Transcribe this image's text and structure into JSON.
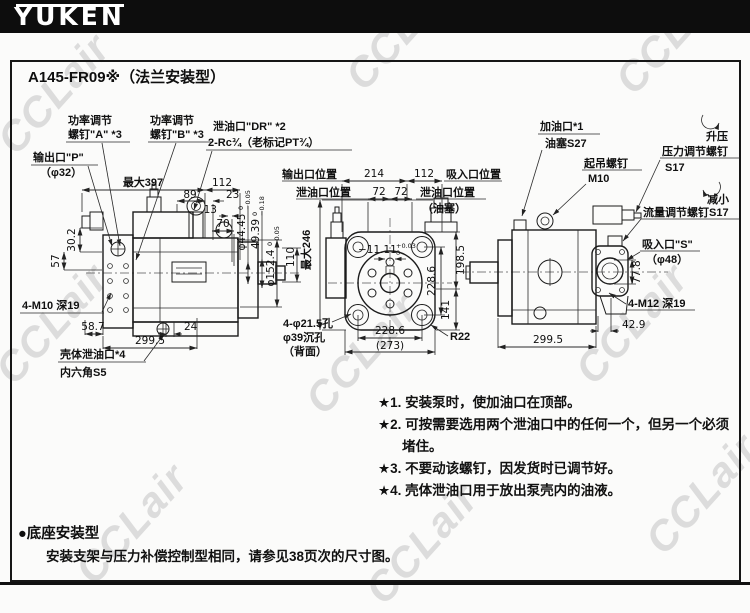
{
  "header": {
    "logo": "YUKEN"
  },
  "watermark": {
    "text": "CCLair"
  },
  "panel": {
    "title": "A145-FR09※（法兰安装型）"
  },
  "left_view": {
    "callouts": {
      "power_a1": "功率调节",
      "power_a2": "螺钉\"A\" *3",
      "power_b1": "功率调节",
      "power_b2": "螺钉\"B\" *3",
      "drain_dr1": "泄油口\"DR\" *2",
      "drain_dr2": "2-Rc¾（老标记PT¾）",
      "outlet1": "输出口\"P\"",
      "outlet2": "（φ32）",
      "mount_holes": "4-M10 深19",
      "case_drain1": "壳体泄油口*4",
      "case_drain2": "内六角S5"
    },
    "dims": {
      "max_len": "最大397",
      "d112": "112",
      "d89": "89",
      "d23": "23",
      "d13": "13",
      "d70": "70",
      "d30_2": "30.2",
      "d57": "57",
      "d58_7": "58.7",
      "d24": "24",
      "d299_5": "299.5",
      "d110": "110",
      "shaft_dia": {
        "main": "φ44.45",
        "tol_top": "0",
        "tol_bot": "−0.05"
      },
      "key_dim": {
        "main": "49.39",
        "tol_top": "0",
        "tol_bot": "−0.18"
      },
      "pilot_dia": {
        "main": "φ152.4",
        "tol_top": "0",
        "tol_bot": "−0.05"
      }
    }
  },
  "middle_view": {
    "callouts": {
      "outlet_pos": "输出口位置",
      "suction_pos": "吸入口位置",
      "drain_pos_l": "泄油口位置",
      "drain_pos_r": "泄油口位置",
      "drain_pos_r2": "（油塞）",
      "holes1": "4-φ21.5孔",
      "holes2": "φ39沉孔",
      "holes3": "（背面）",
      "r22": "R22"
    },
    "dims": {
      "d214": "214",
      "d112": "112",
      "d72a": "72",
      "d72b": "72",
      "max_h": "最大246",
      "d198_5": "198.5",
      "d228_6v": "228.6",
      "d141": "141",
      "d228_6h": "228.6",
      "d273": "(273)",
      "key_off": {
        "main": "−11.11",
        "tol_top": "+0.03",
        "tol_bot": "0"
      }
    }
  },
  "right_view": {
    "callouts": {
      "fill1": "加油口*1",
      "fill2": "油塞S27",
      "lift1": "起吊螺钉",
      "lift2": "M10",
      "press1": "压力调节螺钉",
      "press2": "S17",
      "raise": "升压",
      "reduce": "减小",
      "flow": "流量调节螺钉S17",
      "suction1": "吸入口\"S\"",
      "suction2": "（φ48）",
      "mount": "4-M12 深19"
    },
    "dims": {
      "d77_8": "77.8",
      "d42_9": "42.9",
      "d299_5": "299.5"
    }
  },
  "notes": {
    "n1": "★1. 安装泵时，使加油口在顶部。",
    "n2a": "★2. 可按需要选用两个泄油口中的任何一个，但另一个必须",
    "n2b": "堵住。",
    "n3": "★3. 不要动该螺钉，因发货时已调节好。",
    "n4": "★4. 壳体泄油口用于放出泵壳内的油液。"
  },
  "footer": {
    "bullet": "●底座安装型",
    "text": "安装支架与压力补偿控制型相同，请参见38页次的尺寸图。"
  }
}
